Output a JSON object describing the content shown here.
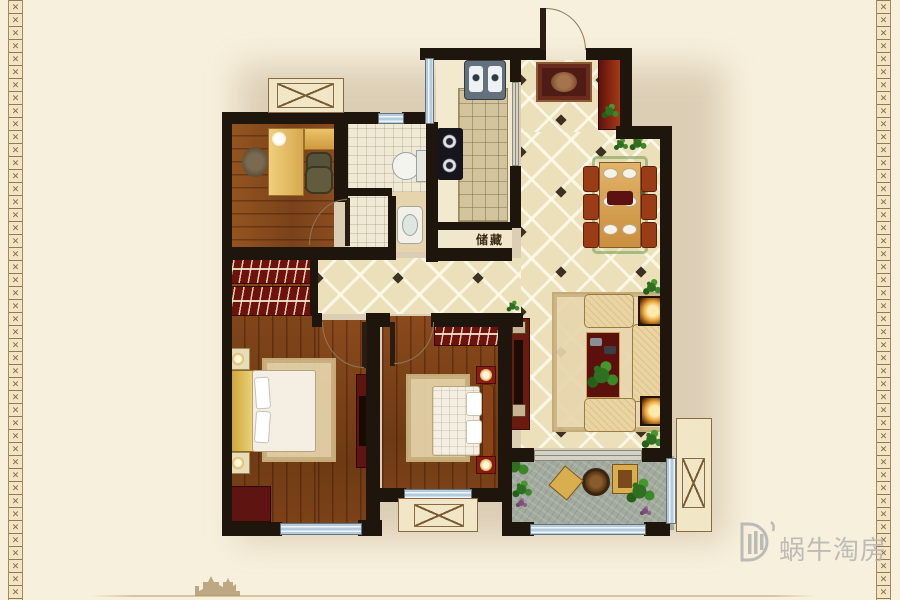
{
  "plan": {
    "storage_label": "储藏"
  },
  "watermark": {
    "brand_text": "蜗牛淘房"
  },
  "decor": {
    "border_glyph": "✕"
  },
  "palette": {
    "background": "#f7f0dc",
    "wall": "#1e150d",
    "wood_floor": "#8a4c1e",
    "tile_floor": "#ece0bb",
    "window_blue": "#b4cbdc",
    "red_furniture": "#6e120c",
    "balcony_gray": "#a2aa9d",
    "border_accent": "#8a6a42",
    "watermark_gray": "#b8b6b2"
  }
}
